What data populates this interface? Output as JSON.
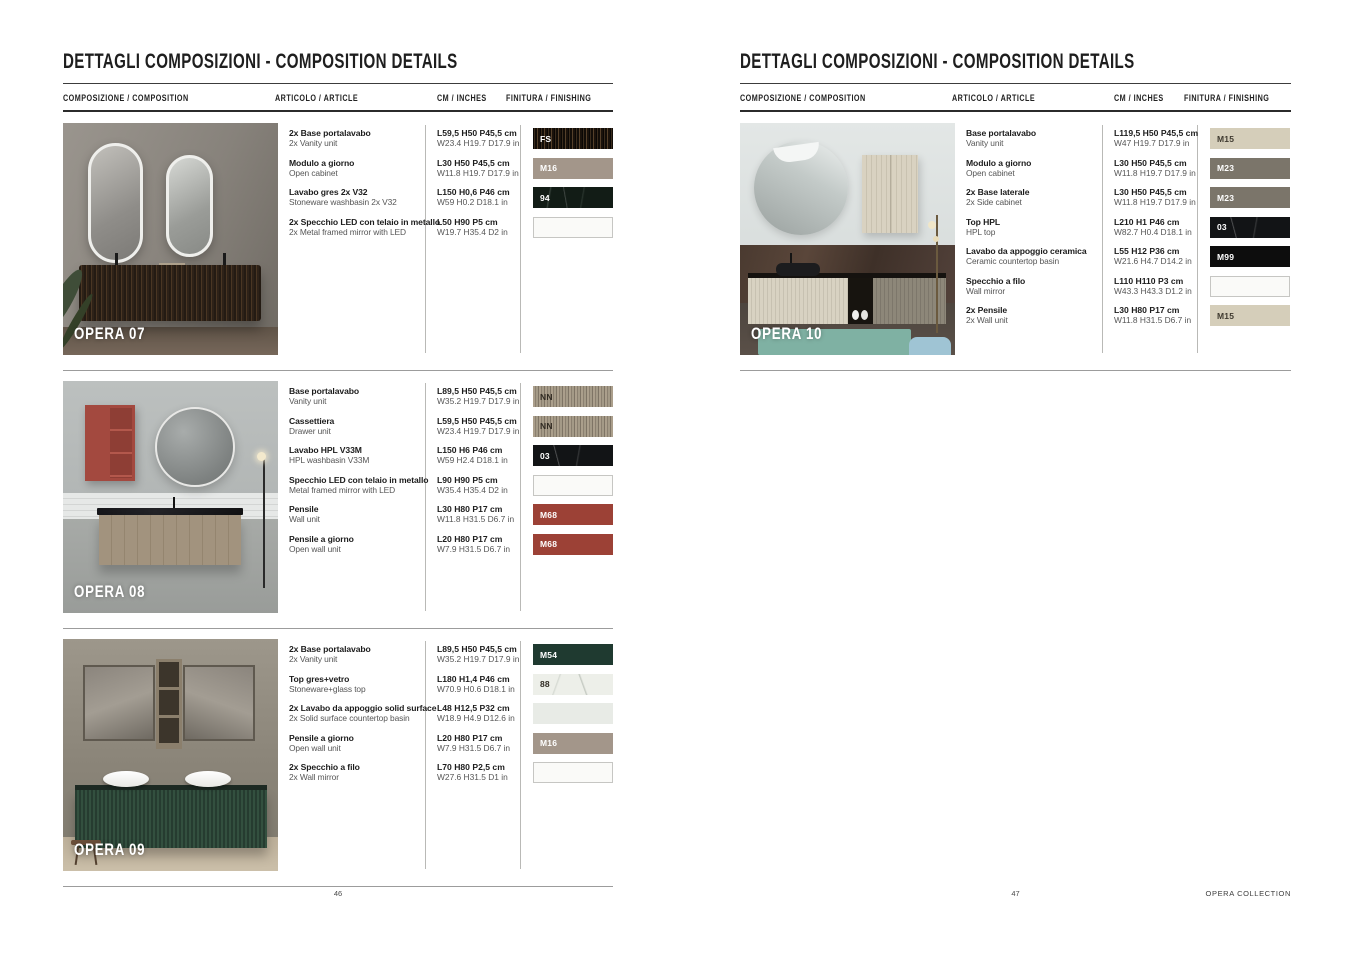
{
  "columns": {
    "composition": "COMPOSIZIONE / COMPOSITION",
    "article": "ARTICOLO / ARTICLE",
    "cm": "CM / INCHES",
    "finishing": "FINITURA / FINISHING"
  },
  "finish_palette": {
    "FS": "#2a2014",
    "M16": "#a3968a",
    "94": "#121c16",
    "NN": "#a79d8b",
    "03": "#121416",
    "M68": "#9c4136",
    "M54": "#1f3a30",
    "88": "#edefe9",
    "M15": "#d5ceba",
    "M23": "#7b756a",
    "M99": "#0d0d0d"
  },
  "page_left": {
    "title": "DETTAGLI COMPOSIZIONI - COMPOSITION DETAILS",
    "page_number": "46",
    "sections": [
      {
        "name": "OPERA 07",
        "scene": "opera07",
        "rows": [
          {
            "article_it": "2x Base portalavabo",
            "article_en": "2x Vanity unit",
            "cm": "L59,5 H50 P45,5 cm",
            "inches": "W23.4 H19.7 D17.9 in",
            "finish": {
              "code": "FS",
              "style": "fs"
            }
          },
          {
            "article_it": "Modulo a giorno",
            "article_en": "Open cabinet",
            "cm": "L30 H50 P45,5 cm",
            "inches": "W11.8 H19.7 D17.9 in",
            "finish": {
              "code": "M16",
              "style": "m16"
            }
          },
          {
            "article_it": "Lavabo gres 2x V32",
            "article_en": "Stoneware washbasin 2x V32",
            "cm": "L150 H0,6 P46 cm",
            "inches": "W59 H0.2 D18.1 in",
            "finish": {
              "code": "94",
              "style": "v94"
            }
          },
          {
            "article_it": "2x Specchio LED con telaio in metallo",
            "article_en": "2x Metal framed mirror with LED",
            "cm": "L50 H90 P5 cm",
            "inches": "W19.7 H35.4 D2 in",
            "finish": {
              "code": "",
              "style": "blank"
            }
          }
        ]
      },
      {
        "name": "OPERA 08",
        "scene": "opera08",
        "rows": [
          {
            "article_it": "Base portalavabo",
            "article_en": "Vanity unit",
            "cm": "L89,5 H50 P45,5 cm",
            "inches": "W35.2 H19.7 D17.9 in",
            "finish": {
              "code": "NN",
              "style": "nn"
            }
          },
          {
            "article_it": "Cassettiera",
            "article_en": "Drawer unit",
            "cm": "L59,5 H50 P45,5 cm",
            "inches": "W23.4 H19.7 D17.9 in",
            "finish": {
              "code": "NN",
              "style": "nn"
            }
          },
          {
            "article_it": "Lavabo HPL V33M",
            "article_en": "HPL washbasin V33M",
            "cm": "L150 H6 P46 cm",
            "inches": "W59 H2.4 D18.1 in",
            "finish": {
              "code": "03",
              "style": "o3"
            }
          },
          {
            "article_it": "Specchio LED con telaio in metallo",
            "article_en": "Metal framed mirror with LED",
            "cm": "L90 H90 P5 cm",
            "inches": "W35.4 H35.4 D2 in",
            "finish": {
              "code": "",
              "style": "blank"
            }
          },
          {
            "article_it": "Pensile",
            "article_en": "Wall unit",
            "cm": "L30 H80 P17 cm",
            "inches": "W11.8 H31.5 D6.7 in",
            "finish": {
              "code": "M68",
              "style": "m68"
            }
          },
          {
            "article_it": "Pensile a giorno",
            "article_en": "Open wall unit",
            "cm": "L20 H80 P17 cm",
            "inches": "W7.9 H31.5 D6.7 in",
            "finish": {
              "code": "M68",
              "style": "m68"
            }
          }
        ]
      },
      {
        "name": "OPERA 09",
        "scene": "opera09",
        "rows": [
          {
            "article_it": "2x Base portalavabo",
            "article_en": "2x Vanity unit",
            "cm": "L89,5 H50 P45,5 cm",
            "inches": "W35.2 H19.7 D17.9 in",
            "finish": {
              "code": "M54",
              "style": "m54"
            }
          },
          {
            "article_it": "Top gres+vetro",
            "article_en": "Stoneware+glass top",
            "cm": "L180 H1,4 P46 cm",
            "inches": "W70.9 H0.6 D18.1 in",
            "finish": {
              "code": "88",
              "style": "v88"
            }
          },
          {
            "article_it": "2x Lavabo da appoggio solid surface",
            "article_en": "2x Solid surface countertop basin",
            "cm": "L48 H12,5 P32 cm",
            "inches": "W18.9 H4.9 D12.6 in",
            "finish": {
              "code": "",
              "style": "light"
            }
          },
          {
            "article_it": "Pensile a giorno",
            "article_en": "Open wall unit",
            "cm": "L20 H80 P17 cm",
            "inches": "W7.9 H31.5 D6.7 in",
            "finish": {
              "code": "M16",
              "style": "m16"
            }
          },
          {
            "article_it": "2x Specchio a filo",
            "article_en": "2x Wall mirror",
            "cm": "L70 H80 P2,5 cm",
            "inches": "W27.6 H31.5 D1 in",
            "finish": {
              "code": "",
              "style": "blank"
            }
          }
        ]
      }
    ]
  },
  "page_right": {
    "title": "DETTAGLI COMPOSIZIONI - COMPOSITION DETAILS",
    "page_number": "47",
    "footer_right": "OPERA COLLECTION",
    "sections": [
      {
        "name": "OPERA 10",
        "scene": "opera10",
        "rows": [
          {
            "article_it": "Base portalavabo",
            "article_en": "Vanity unit",
            "cm": "L119,5 H50 P45,5 cm",
            "inches": "W47 H19.7 D17.9 in",
            "finish": {
              "code": "M15",
              "style": "m15"
            }
          },
          {
            "article_it": "Modulo a giorno",
            "article_en": "Open cabinet",
            "cm": "L30 H50 P45,5 cm",
            "inches": "W11.8 H19.7 D17.9 in",
            "finish": {
              "code": "M23",
              "style": "m23"
            }
          },
          {
            "article_it": "2x Base laterale",
            "article_en": "2x Side cabinet",
            "cm": "L30 H50 P45,5 cm",
            "inches": "W11.8 H19.7 D17.9 in",
            "finish": {
              "code": "M23",
              "style": "m23"
            }
          },
          {
            "article_it": "Top HPL",
            "article_en": "HPL top",
            "cm": "L210 H1 P46 cm",
            "inches": "W82.7 H0.4 D18.1 in",
            "finish": {
              "code": "03",
              "style": "o3"
            }
          },
          {
            "article_it": "Lavabo da appoggio ceramica",
            "article_en": "Ceramic countertop basin",
            "cm": "L55 H12 P36 cm",
            "inches": "W21.6 H4.7 D14.2 in",
            "finish": {
              "code": "M99",
              "style": "m99"
            }
          },
          {
            "article_it": "Specchio a filo",
            "article_en": "Wall mirror",
            "cm": "L110 H110 P3 cm",
            "inches": "W43.3 H43.3 D1.2 in",
            "finish": {
              "code": "",
              "style": "blank"
            }
          },
          {
            "article_it": "2x Pensile",
            "article_en": "2x Wall unit",
            "cm": "L30 H80 P17 cm",
            "inches": "W11.8 H31.5 D6.7 in",
            "finish": {
              "code": "M15",
              "style": "m15"
            }
          }
        ]
      }
    ]
  }
}
